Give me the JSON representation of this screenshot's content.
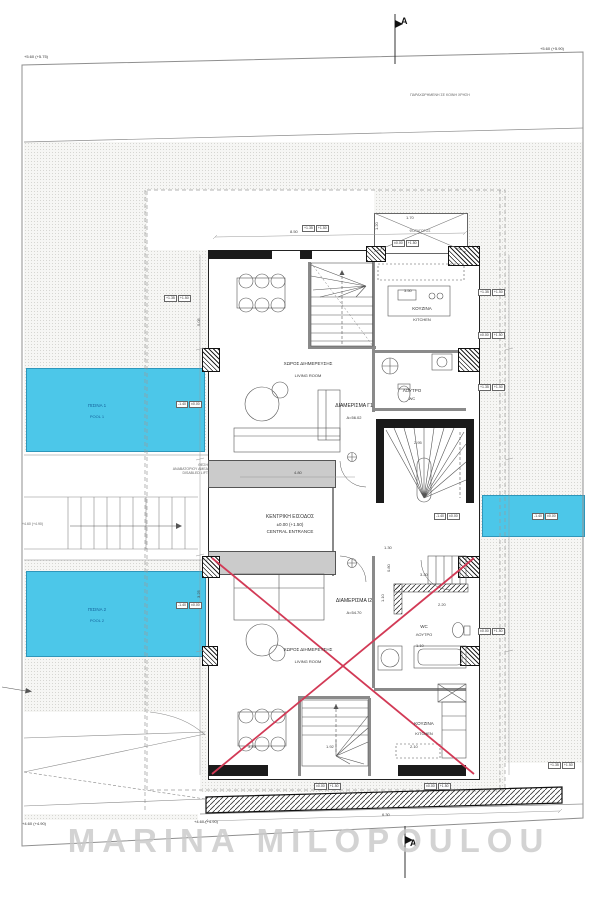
{
  "watermark": "MARINA MILOPOULOU",
  "section_markers": {
    "top": "A",
    "bottom": "A"
  },
  "site": {
    "note_top": "ΠΑΡΑΧΩΡΗΜΕΝΗ ΣΕ ΚΟΙΝΗ ΧΡΗΣΗ",
    "elev_top_left": "+5.60 (+5.75)",
    "elev_top_right": "+5.60 (+5.90)",
    "elev_bottom_left": "+4.60 (+4.90)",
    "elev_bottom_mid": "+4.60 (+4.90)",
    "stair_note": "+4.60 (+4.90)",
    "lift_lines": [
      "ΘΕΣΗ",
      "ΑΝΑΒΑΤΟΡΙΟΥ ΑΜΕΑ",
      "DISABLED LIFT"
    ]
  },
  "pools": {
    "p1": {
      "el": "ΠΙΣΙΝΑ 1",
      "en": "POOL 1"
    },
    "p2": {
      "el": "ΠΙΣΙΝΑ 2",
      "en": "POOL 2"
    }
  },
  "entrance": {
    "l1": "ΚΕΝΤΡΙΚΗ ΕΙΣΟΔΟΣ",
    "l2": "±0.00 (+1.50)",
    "l3": "CENTRAL ENTRANCE"
  },
  "apartments": {
    "g1": {
      "name": "ΔΙΑΜΕΡΙΣΜΑ Γ1",
      "area": "Α=56.02",
      "living_el": "ΧΩΡΟΣ ΔΙΗΜΕΡΕΥΣΗΣ",
      "living_en": "LIVING ROOM",
      "kitchen_el": "ΚΟΥΖΙΝΑ",
      "kitchen_en": "KITCHEN",
      "wc_el": "ΛΟΥΤΡΟ",
      "wc_en": "WC"
    },
    "i2": {
      "name": "ΔΙΑΜΕΡΙΣΜΑ Ι2",
      "area": "Α=54.70",
      "living_el": "ΧΩΡΟΣ ΔΙΗΜΕΡΕΥΣΗΣ",
      "living_en": "LIVING ROOM",
      "kitchen_el": "ΚΟΥΖΙΝΑ",
      "kitchen_en": "KITCHEN",
      "wc_el": "WC",
      "wc_en": "ΛΟΥΤΡΟ"
    }
  },
  "lightwell": "ΦΩΤΑΓΩΓΟΣ",
  "dims": {
    "top": "8.50",
    "corridor": "4.80",
    "kitchen": "3.50",
    "stair": "2.95",
    "d130": "1.30",
    "bath_w": "3.20",
    "bath_d": "2.20",
    "wc_w": "1.10",
    "closet": "0.80",
    "closet2": "1.10",
    "dining_low": "3.25",
    "stair_low": "1.92",
    "kitchen_low": "2.10",
    "bottom": "6.30",
    "left_v": "5.05",
    "left_v2": "3.25",
    "annex_w": "1.70",
    "annex_h": "1.20"
  },
  "markers": {
    "entry": [
      "±0.00",
      "+1.50"
    ],
    "pool": [
      "-1.40",
      "±0.00"
    ],
    "ground": [
      "+1.35",
      "+1.50"
    ]
  },
  "colors": {
    "pool": "#4cc7e9",
    "red_x": "#d23a56",
    "wall": "#1b1b1b",
    "stipple": "#f6f6f4",
    "watermark": "#c9c9c9"
  }
}
